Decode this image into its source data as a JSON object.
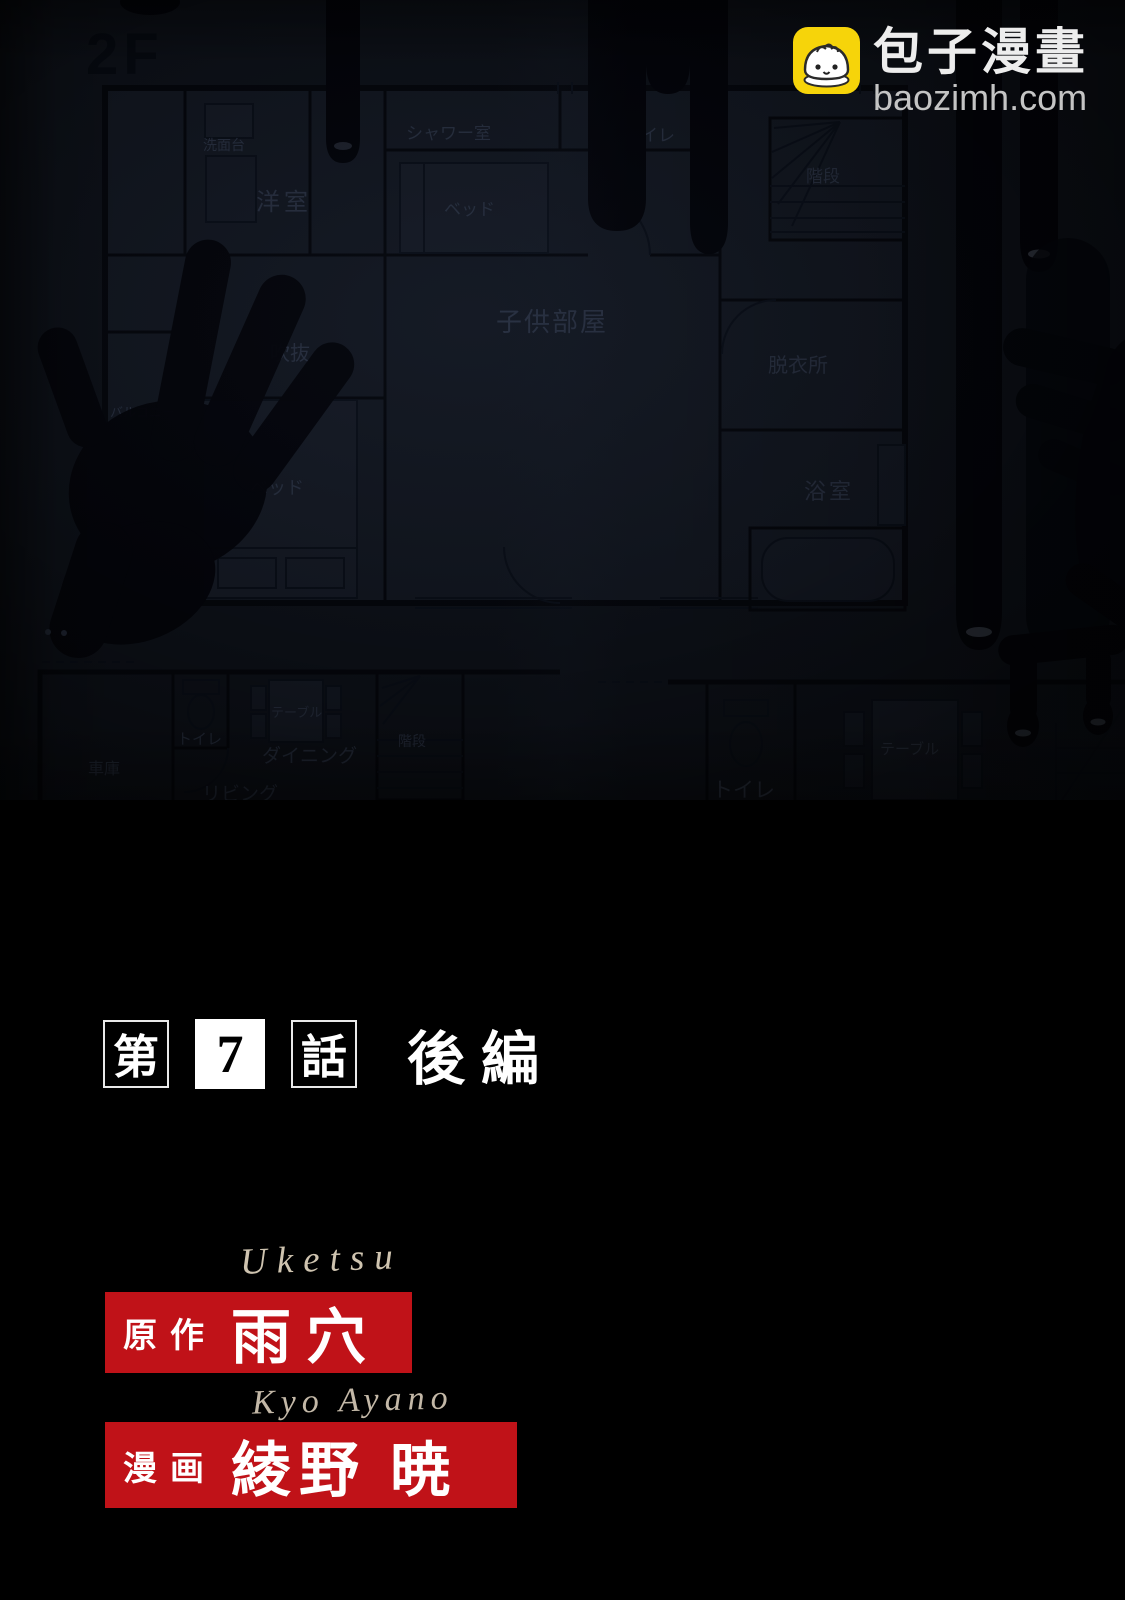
{
  "watermark": {
    "site_name": "包子漫畫",
    "site_domain": "baozimh.com"
  },
  "chapter": {
    "prefix": "第",
    "number": "7",
    "suffix": "話",
    "part": "後編"
  },
  "credits": {
    "original": {
      "romaji": "Uketsu",
      "label": "原作",
      "name": "雨穴"
    },
    "artist": {
      "romaji": "Kyo Ayano",
      "label": "漫画",
      "name": "綾野 暁"
    }
  },
  "floorplan": {
    "floor_label": "2F",
    "f2": {
      "washstand": "洗面台",
      "western_room": "洋室",
      "shower_room": "シャワー室",
      "toilet": "トイレ",
      "stairs": "階段",
      "bed_top": "ベッド",
      "kids_room": "子供部屋",
      "atrium": "吹抜",
      "balcony": "バルコニー",
      "bed_left": "ベッド",
      "dressing_room": "脱衣所",
      "bathroom": "浴室"
    },
    "f1_left": {
      "garage": "車庫",
      "toilet": "トイレ",
      "table": "テーブル",
      "dining": "ダイニング",
      "living": "リビング",
      "stairs": "階段"
    },
    "f1_right": {
      "toilet": "トイレ",
      "table": "テーブル"
    }
  },
  "colors": {
    "accent_red": "#c01218",
    "icon_yellow": "#f6d40a",
    "romaji_ink": "#cfc4b0"
  }
}
